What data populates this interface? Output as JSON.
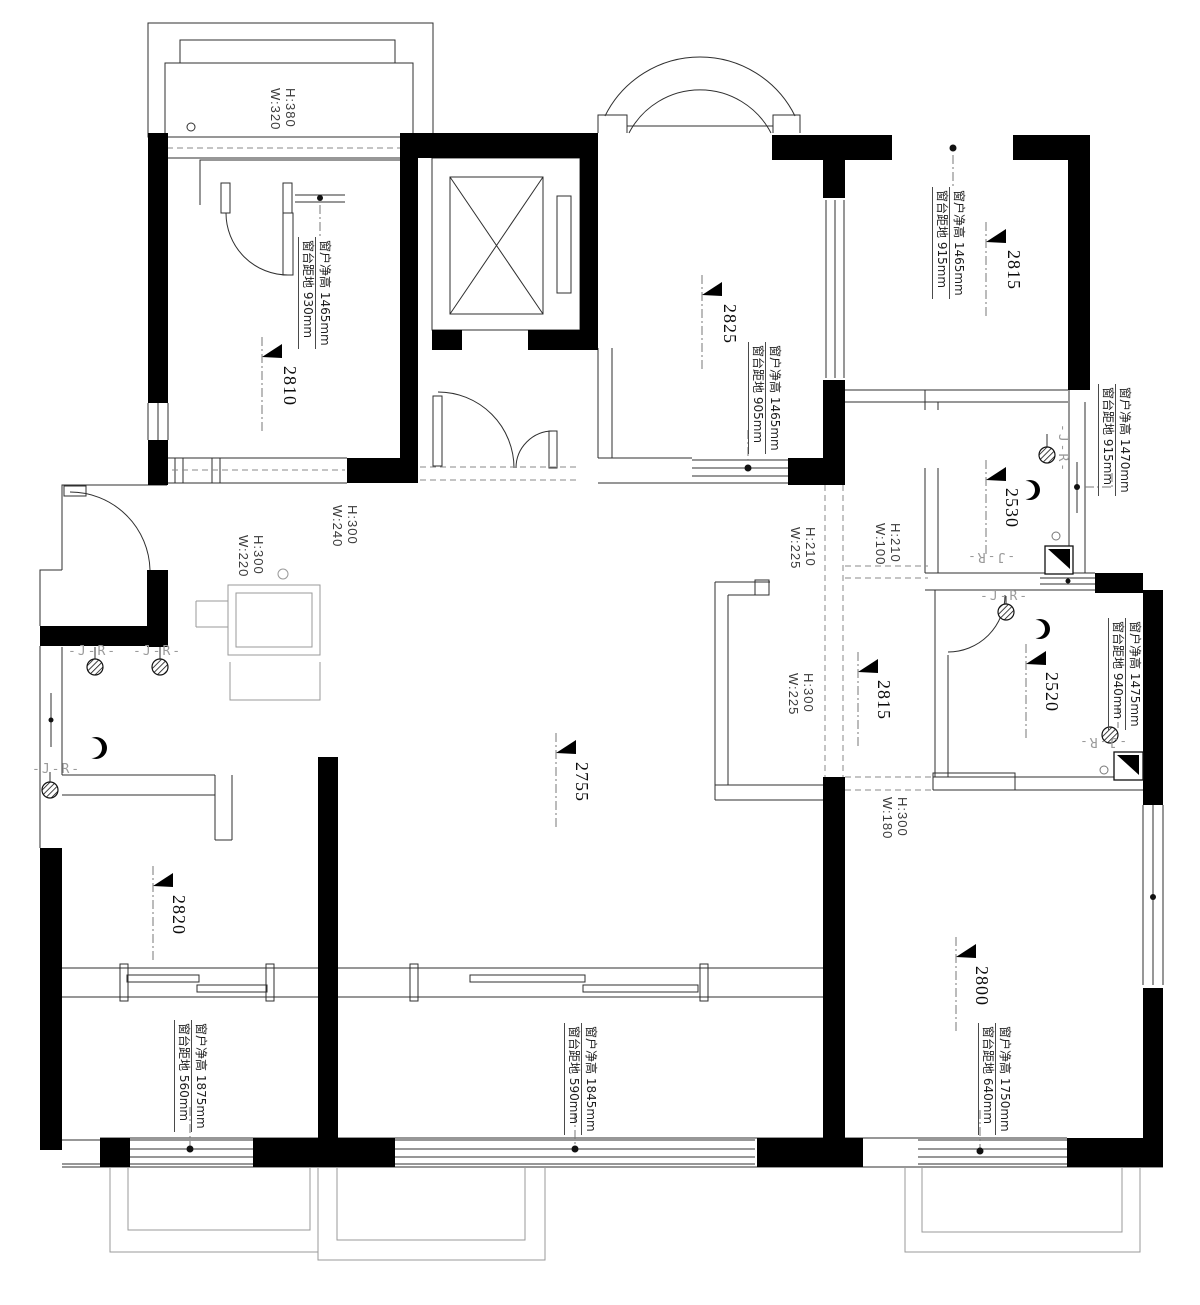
{
  "plan": {
    "markers": {
      "top_left": "2810",
      "top_mid": "2825",
      "top_right": "2815",
      "bath1": "2530",
      "bath2": "2520",
      "hall": "2815",
      "living": "2755",
      "bottom_left": "2820",
      "bottom_right": "2800"
    },
    "window_notes": {
      "top_left": {
        "h": "窗户净高 1465mm",
        "s": "窗台距地 930mm"
      },
      "top_mid": {
        "h": "窗户净高 1465mm",
        "s": "窗台距地 905mm"
      },
      "top_right": {
        "h": "窗户净高 1465mm",
        "s": "窗台距地 915mm"
      },
      "bath1": {
        "h": "窗户净高 1470mm",
        "s": "窗台距地 915mm"
      },
      "bath2": {
        "h": "窗户净高 1475mm",
        "s": "窗台距地 940mm"
      },
      "bottom_left": {
        "h": "窗户净高 1875mm",
        "s": "窗台距地 560mm"
      },
      "bottom_mid": {
        "h": "窗户净高 1845mm",
        "s": "窗台距地 590mm"
      },
      "bottom_right": {
        "h": "窗户净高 1750mm",
        "s": "窗台距地 640mm"
      }
    },
    "openings": {
      "balcony_top_left": {
        "h": "H:380",
        "w": "W:320"
      },
      "entry": {
        "h": "H:300",
        "w": "W:220"
      },
      "hall_left": {
        "h": "H:300",
        "w": "W:240"
      },
      "hall_top": {
        "h": "H:210",
        "w": "W:225"
      },
      "bath_hall": {
        "h": "H:210",
        "w": "W:100"
      },
      "hall_mid": {
        "h": "H:300",
        "w": "W:225"
      },
      "bedroom_right": {
        "h": "H:300",
        "w": "W:180"
      }
    },
    "plumbing": {
      "jr": "-J-R-"
    },
    "colors": {
      "wall": "#000000",
      "line": "#2f2f2f",
      "light": "#9a9a9a"
    }
  }
}
